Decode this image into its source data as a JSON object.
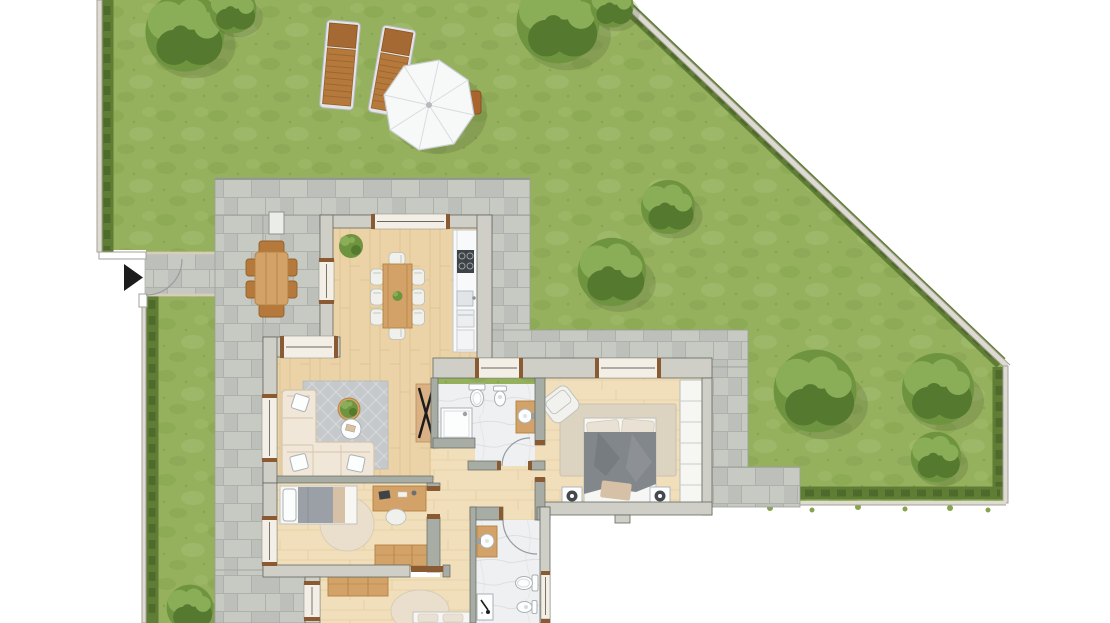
{
  "scene": {
    "type": "architectural-floor-plan",
    "title": "Ground-floor apartment with private garden and stone terrace",
    "visible_text": [],
    "orientation": "top-down render"
  },
  "palette": {
    "bg": "#ffffff",
    "grass": "#95b15e",
    "grass2": "#86a34f",
    "grass3": "#a6bf71",
    "hedge": "#5f7d34",
    "hedge2": "#4c672a",
    "fence": "#dedbd3",
    "fenceEdge": "#a5a198",
    "tile": "#c7c9c3",
    "tile2": "#bdc0ba",
    "joint": "#aeb0aa",
    "patioEdge": "#99a095",
    "wallExt": "#d0cfc7",
    "wallInt": "#a7aca5",
    "wallEdge": "#63685f",
    "window": "#f3efe6",
    "glass": "#6b675f",
    "doorwood": "#8a5a33",
    "wood": "#ebd3a7",
    "woodLine": "#dcc091",
    "wood2": "#f1dfbb",
    "woodLine2": "#e3cda0",
    "furn": "#d3a268",
    "furnEdge": "#b4813f",
    "furnDark": "#b5793c",
    "furnDarkEdge": "#96602a",
    "counter": "#f8f9fa",
    "counterEdge": "#c3c8cd",
    "marble": "#eef0f1",
    "vein": "#d8dbde",
    "fixture": "#fcfdfd",
    "fixtureEdge": "#aab1b7",
    "sofa": "#f0e7d8",
    "sofaEdge": "#d4c4ac",
    "rugBlue": "#c5c9cb",
    "rugBlue2": "#d7dadb",
    "rugBeige": "#e9dfcc",
    "rugTan": "#dcd4c1",
    "duvet": "#82878c",
    "duvetDark": "#6d7277",
    "sheet": "#f6f6f4",
    "pillow": "#e9e2d4",
    "throw": "#d6c0a6",
    "chair": "#f0f0ec",
    "chairEdge": "#b9bdb8",
    "appliance": "#3e4347",
    "dark": "#1c1c1c",
    "umbrella": "#f7f8f8",
    "umbrellaEdge": "#c9cdd0",
    "rib": "#d9dcdf",
    "plant": "#6f9440",
    "plant2": "#8aad58",
    "plant3": "#55792e",
    "arc": "#979da3",
    "lamp": "#45494d",
    "wardrobe": "#f6f6f3",
    "wardrobeLine": "#cbcfc9",
    "shadow": "rgba(60,70,40,0.18)"
  },
  "garden": {
    "ground": "lawn",
    "boundaries": [
      {
        "name": "west-fence-with-hedge",
        "side": "left"
      },
      {
        "name": "diagonal-fence-with-hedge",
        "side": "north-east"
      },
      {
        "name": "east-fence-with-hedge",
        "side": "right"
      },
      {
        "name": "south-hedge",
        "side": "bottom-right"
      }
    ],
    "entrance": {
      "name": "garden-gate",
      "marker": "black-arrow",
      "walkway": "stone-slabs"
    },
    "elements": [
      {
        "name": "sun-lounger",
        "count": 2,
        "material": "wood"
      },
      {
        "name": "parasol",
        "shape": "octagon",
        "color": "white"
      },
      {
        "name": "parasol-side-table",
        "material": "wood"
      },
      {
        "name": "bush",
        "count": 7
      },
      {
        "name": "tree",
        "count": 3
      }
    ]
  },
  "terrace": {
    "material": "stone-tiles",
    "furniture": [
      {
        "name": "outdoor-dining-table",
        "seats": 6,
        "material": "wood"
      },
      {
        "name": "storage-box"
      }
    ]
  },
  "apartment": {
    "rooms": [
      {
        "name": "kitchen-dining",
        "floor": "wood",
        "furniture": [
          "dining-table",
          "dining-chairs-x8",
          "table-plant",
          "corner-plant",
          "kitchen-counter",
          "cooktop",
          "sink",
          "oven",
          "fridge"
        ]
      },
      {
        "name": "living-room",
        "floor": "wood",
        "furniture": [
          "corner-sofa",
          "throw-pillows-x4",
          "area-rug",
          "round-plant-table",
          "round-coffee-table",
          "x-leg-console"
        ]
      },
      {
        "name": "bathroom-1",
        "floor": "marble",
        "furniture": [
          "shower",
          "toilet",
          "bidet",
          "vanity-basin"
        ],
        "window": true,
        "door": "swing"
      },
      {
        "name": "master-bedroom",
        "floor": "wood",
        "furniture": [
          "double-bed",
          "nightstand-x2",
          "table-lamp-x2",
          "armchair",
          "area-rug",
          "wardrobe"
        ],
        "window": true
      },
      {
        "name": "bedroom-2",
        "floor": "wood",
        "furniture": [
          "single-bed",
          "desk",
          "desk-chair",
          "round-rug",
          "sideboard"
        ],
        "window": true
      },
      {
        "name": "bedroom-3",
        "floor": "wood",
        "furniture": [
          "dresser",
          "round-rug",
          "bed-partially-visible"
        ],
        "window": true
      },
      {
        "name": "bathroom-2",
        "floor": "marble",
        "furniture": [
          "vanity-basin",
          "shower",
          "toilet",
          "bidet"
        ],
        "window": true,
        "door": "swing"
      },
      {
        "name": "hallway",
        "floor": "wood",
        "furniture": []
      }
    ]
  }
}
